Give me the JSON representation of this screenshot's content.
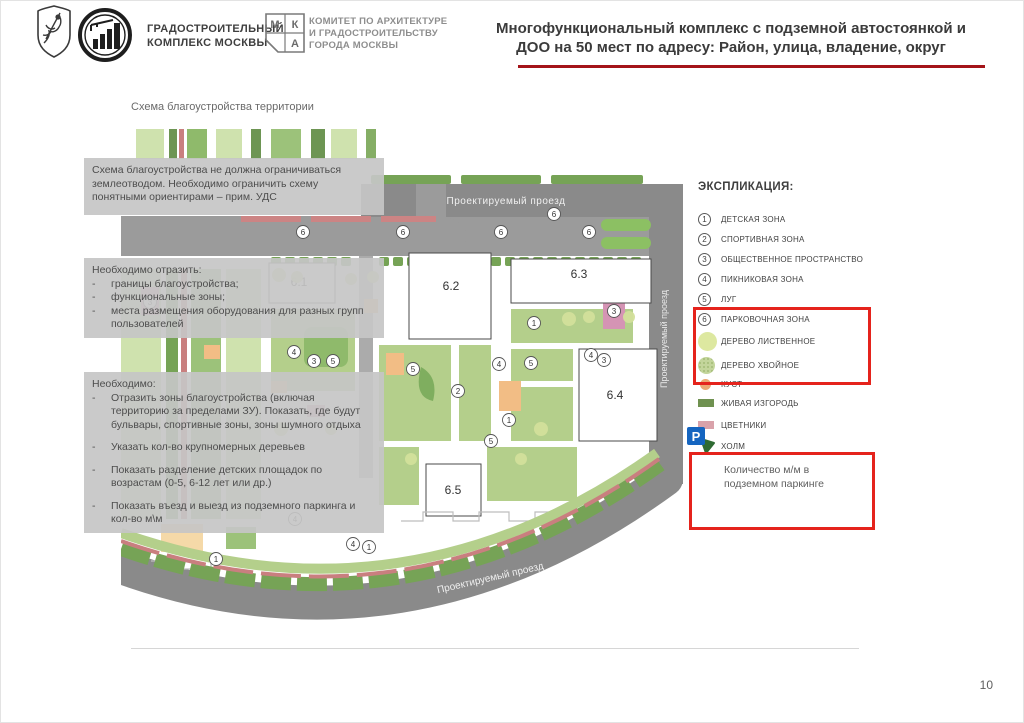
{
  "header": {
    "org1_line1": "ГРАДОСТРОИТЕЛЬНЫЙ",
    "org1_line2": "КОМПЛЕКС МОСКВЫ",
    "mka": {
      "m": "М",
      "k": "К",
      "a": "А"
    },
    "org2_line1": "КОМИТЕТ ПО АРХИТЕКТУРЕ",
    "org2_line2": "И ГРАДОСТРОИТЕЛЬСТВУ",
    "org2_line3": "ГОРОДА МОСКВЫ",
    "title_line1": "Многофункциональный комплекс с подземной автостоянкой и",
    "title_line2": "ДОО на 50 мест по адресу: Район, улица, владение, округ",
    "accent_color": "#a41419"
  },
  "subtitle": "Схема благоустройства территории",
  "notes": {
    "dash": "-",
    "box1": {
      "text": "Схема благоустройства не должна ограничиваться землеотводом. Необходимо ограничить схему понятными ориентирами – прим. УДС"
    },
    "box2": {
      "title": "Необходимо отразить:",
      "items": [
        "границы благоустройства;",
        "функциональные зоны;",
        "места размещения оборудования для разных групп пользователей"
      ]
    },
    "box3": {
      "title": "Необходимо:",
      "items": [
        "Отразить зоны благоустройства (включая территорию за пределами ЗУ). Показать, где будут бульвары, спортивные зоны, зоны шумного отдыха",
        "Указать кол-во крупномерных деревьев",
        "Показать разделение детских площадок по возрастам (0-5, 6-12 лет или др.)",
        "Показать въезд и выезд из подземного паркинга и кол-во м\\м"
      ]
    }
  },
  "plan": {
    "road_labels": {
      "top": "Проектируемый проезд",
      "right": "Проектируемый проезд",
      "bottom": "Проектируемый проезд"
    },
    "buildings": [
      "6.1",
      "6.2",
      "6.3",
      "6.4",
      "6.5"
    ],
    "markers": [
      {
        "x": 182,
        "y": 103,
        "n": "6"
      },
      {
        "x": 282,
        "y": 103,
        "n": "6"
      },
      {
        "x": 380,
        "y": 103,
        "n": "6"
      },
      {
        "x": 468,
        "y": 103,
        "n": "6"
      },
      {
        "x": 433,
        "y": 85,
        "n": "6"
      },
      {
        "x": 212,
        "y": 232,
        "n": "5"
      },
      {
        "x": 292,
        "y": 240,
        "n": "5"
      },
      {
        "x": 410,
        "y": 234,
        "n": "5"
      },
      {
        "x": 370,
        "y": 312,
        "n": "5"
      },
      {
        "x": 173,
        "y": 223,
        "n": "4"
      },
      {
        "x": 378,
        "y": 235,
        "n": "4"
      },
      {
        "x": 470,
        "y": 226,
        "n": "4"
      },
      {
        "x": 174,
        "y": 390,
        "n": "4"
      },
      {
        "x": 232,
        "y": 415,
        "n": "4"
      },
      {
        "x": 29,
        "y": 173,
        "n": "3"
      },
      {
        "x": 193,
        "y": 232,
        "n": "3"
      },
      {
        "x": 483,
        "y": 231,
        "n": "3"
      },
      {
        "x": 493,
        "y": 182,
        "n": "3"
      },
      {
        "x": 413,
        "y": 194,
        "n": "1"
      },
      {
        "x": 388,
        "y": 291,
        "n": "1"
      },
      {
        "x": 95,
        "y": 430,
        "n": "1"
      },
      {
        "x": 248,
        "y": 418,
        "n": "1"
      },
      {
        "x": 337,
        "y": 262,
        "n": "2"
      }
    ]
  },
  "legend": {
    "title": "ЭКСПЛИКАЦИЯ:",
    "numbered": [
      {
        "num": "1",
        "label": "ДЕТСКАЯ ЗОНА"
      },
      {
        "num": "2",
        "label": "СПОРТИВНАЯ ЗОНА"
      },
      {
        "num": "3",
        "label": "ОБЩЕСТВЕННОЕ ПРОСТРАНСТВО"
      },
      {
        "num": "4",
        "label": "ПИКНИКОВАЯ ЗОНА"
      },
      {
        "num": "5",
        "label": "ЛУГ"
      },
      {
        "num": "6",
        "label": "ПАРКОВОЧНАЯ ЗОНА"
      }
    ],
    "swatches": [
      {
        "label": "ДЕРЕВО ЛИСТВЕННОЕ",
        "color": "#dde8a0"
      },
      {
        "label": "ДЕРЕВО ХВОЙНОЕ",
        "color": "#c3d59b"
      },
      {
        "label": "КУСТ",
        "color": "#eba873"
      },
      {
        "label": "ЖИВАЯ ИЗГОРОДЬ",
        "color": "#6f9150"
      },
      {
        "label": "ЦВЕТНИКИ",
        "color": "#d9a2aa"
      },
      {
        "label": "ХОЛМ",
        "color": "#2f6b33"
      }
    ],
    "parking_icon_letter": "P"
  },
  "callout": {
    "text": "Количество м/м в подземном паркинге"
  },
  "page_number": "10"
}
